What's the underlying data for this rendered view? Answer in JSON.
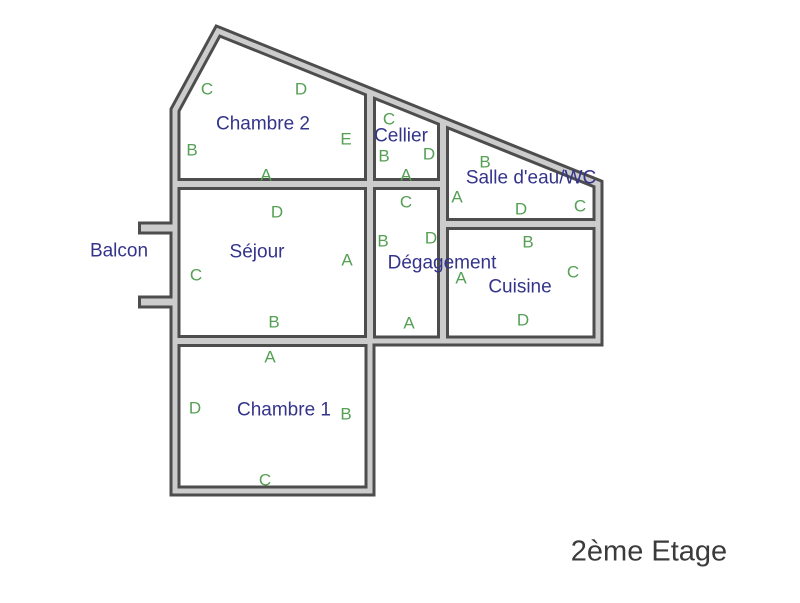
{
  "title": "2ème Etage",
  "colors": {
    "wall_dark": "#4d4d4d",
    "wall_light": "#cccccc",
    "room_name_blue": "#34348c",
    "letter_green": "#55a055",
    "title_gray": "#3b3b3b",
    "background": "#ffffff"
  },
  "rooms": {
    "chambre2": {
      "label": "Chambre 2"
    },
    "cellier": {
      "label": "Cellier"
    },
    "salle_eau": {
      "label": "Salle d'eau/WC"
    },
    "sejour": {
      "label": "Séjour"
    },
    "degagement": {
      "label": "Dégagement"
    },
    "cuisine": {
      "label": "Cuisine"
    },
    "chambre1": {
      "label": "Chambre 1"
    },
    "balcon": {
      "label": "Balcon"
    }
  },
  "wall_letters": {
    "chambre2": {
      "top_left": "C",
      "top_right": "D",
      "left": "B",
      "right": "E",
      "bottom": "A"
    },
    "cellier": {
      "top": "C",
      "left": "B",
      "right": "D",
      "bottom": "A"
    },
    "salle_eau": {
      "top": "B",
      "left": "A",
      "right": "C",
      "bottom": "D"
    },
    "sejour": {
      "top": "D",
      "left": "C",
      "right": "A",
      "bottom": "B"
    },
    "degagement": {
      "top": "C",
      "left": "B",
      "right": "D",
      "bottom": "A"
    },
    "cuisine": {
      "top": "B",
      "left": "A",
      "right": "C",
      "bottom": "D"
    },
    "chambre1": {
      "top": "A",
      "left": "D",
      "right": "B",
      "bottom": "C"
    }
  }
}
